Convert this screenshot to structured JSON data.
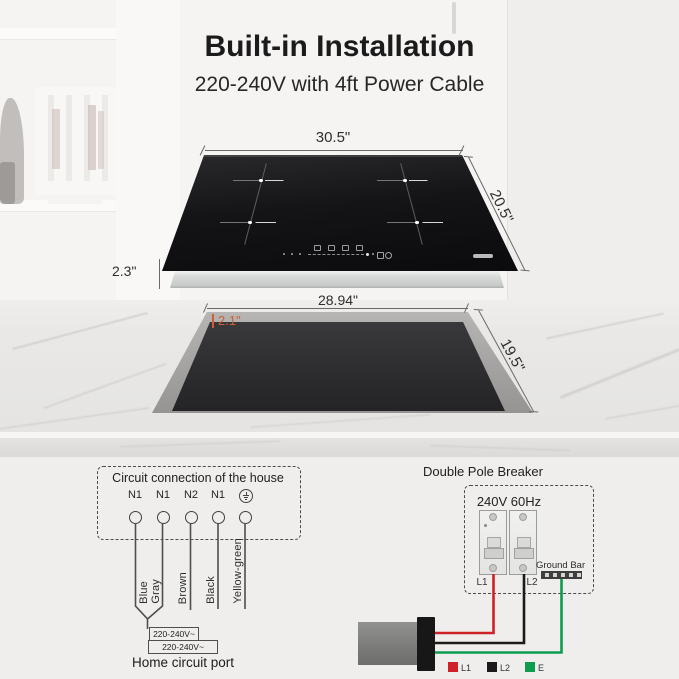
{
  "header": {
    "title": "Built-in Installation",
    "subtitle": "220-240V with 4ft Power Cable"
  },
  "cooktop_diagram": {
    "width": "30.5\"",
    "depth": "20.5\"",
    "height": "2.3\"",
    "burner_count": 4,
    "surface_color": "#111113"
  },
  "cutout_diagram": {
    "width": "28.94\"",
    "edge_inset": "2.1\"",
    "depth": "19.5\"",
    "inset_label_color": "#cf5f33"
  },
  "wiring": {
    "circuit_box": {
      "title": "Circuit connection of the house",
      "terminals": [
        "N1",
        "N1",
        "N2",
        "N1"
      ],
      "ground_icon": "earth-ground-icon",
      "wires": [
        "Blue",
        "Gray",
        "Brown",
        "Black",
        "Yellow-green"
      ],
      "voltage_top": "220-240V~",
      "voltage_bottom": "220-240V~",
      "caption": "Home circuit port"
    },
    "breaker": {
      "title": "Double Pole Breaker",
      "rating": "240V 60Hz",
      "poles": [
        "L1",
        "L2"
      ],
      "ground_bar_label": "Ground Bar",
      "wire_colors": {
        "L1": "#cf2127",
        "L2": "#1b1b1b",
        "E": "#0e9c4f"
      },
      "legend": [
        {
          "label": "L1",
          "color": "#cf2127"
        },
        {
          "label": "L2",
          "color": "#1b1b1b"
        },
        {
          "label": "E",
          "color": "#0e9c4f"
        }
      ]
    }
  }
}
